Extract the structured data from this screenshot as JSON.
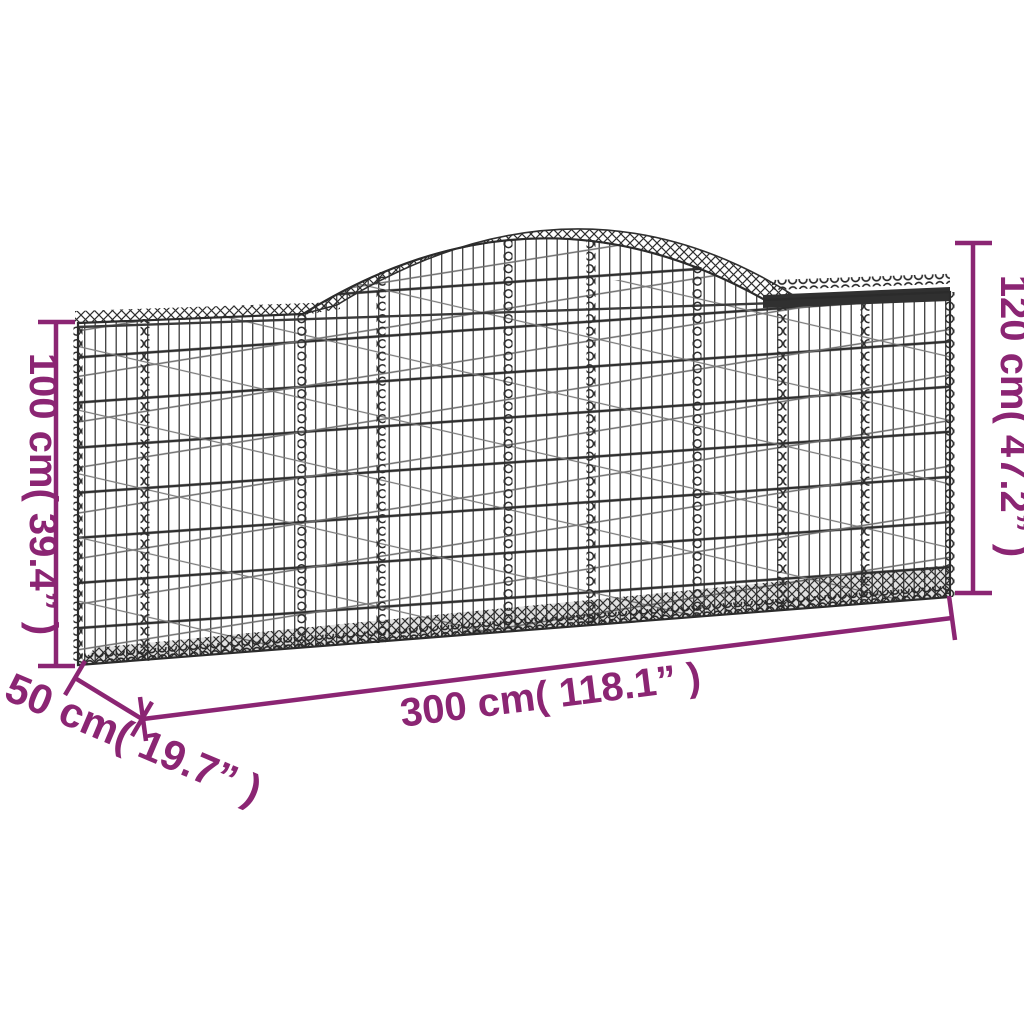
{
  "title": "Arched gabion basket dimension diagram",
  "colors": {
    "dimension": "#8B2573",
    "wire_dark": "#2d2d2d",
    "background": "#ffffff"
  },
  "dimensions": {
    "height_left": {
      "value_cm": 100,
      "value_inch": 39.4,
      "label": "100 cm( 39.4” )"
    },
    "height_right": {
      "value_cm": 120,
      "value_inch": 47.2,
      "label": "120 cm( 47.2” )"
    },
    "length": {
      "value_cm": 300,
      "value_inch": 118.1,
      "label": "300 cm( 118.1” )"
    },
    "depth": {
      "value_cm": 50,
      "value_inch": 19.7,
      "label": "50 cm( 19.7” )"
    }
  }
}
